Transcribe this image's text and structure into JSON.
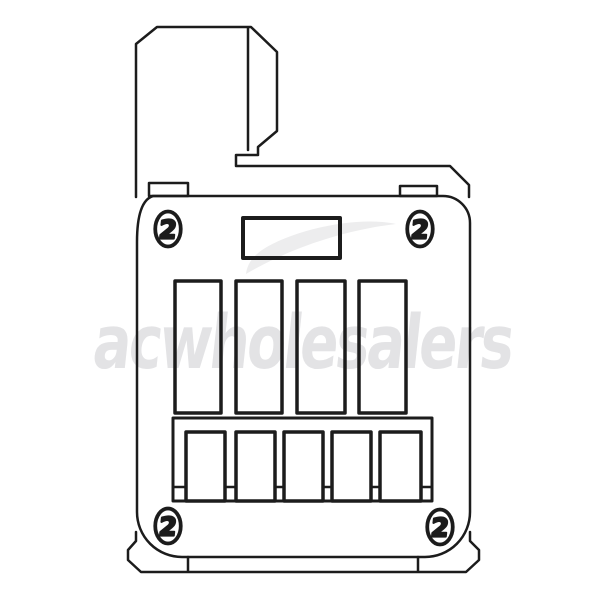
{
  "figure": {
    "description": "Black line-art technical product drawing of a relay / control terminal module with mounting arm, four screw heads, label plate, four relay slots and a five-pin terminal block",
    "colors": {
      "background": "#ffffff",
      "line": "#1c1c1c"
    },
    "watermark": {
      "text": "acwholesalers",
      "text_color": "#e3e3e5",
      "swoosh_color": "#ededee"
    },
    "screws": {
      "glyph": "2",
      "centers": [
        [
          168,
          229
        ],
        [
          420,
          229
        ],
        [
          168,
          526
        ],
        [
          440,
          527
        ]
      ]
    },
    "tabs": [
      [
        149,
        183,
        39,
        13
      ],
      [
        400,
        186,
        37,
        10
      ]
    ],
    "label_plate": [
      [
        243,
        218,
        97,
        40
      ]
    ],
    "slots": [
      [
        175,
        281,
        46,
        132
      ],
      [
        236,
        281,
        46,
        132
      ],
      [
        297,
        281,
        48,
        132
      ],
      [
        359,
        281,
        47,
        132
      ]
    ],
    "terminal_block": {
      "outer": [
        [
          173,
          418,
          259,
          83
        ]
      ],
      "pins": [
        [
          186,
          432,
          39,
          69
        ],
        [
          236,
          432,
          39,
          69
        ],
        [
          284,
          432,
          39,
          69
        ],
        [
          332,
          432,
          39,
          69
        ],
        [
          380,
          432,
          41,
          69
        ]
      ],
      "gap_line_y": 487,
      "gaps": [
        [
          174,
          186
        ],
        [
          226,
          235
        ],
        [
          276,
          283
        ],
        [
          324,
          331
        ],
        [
          372,
          379
        ],
        [
          421,
          431
        ]
      ]
    }
  }
}
